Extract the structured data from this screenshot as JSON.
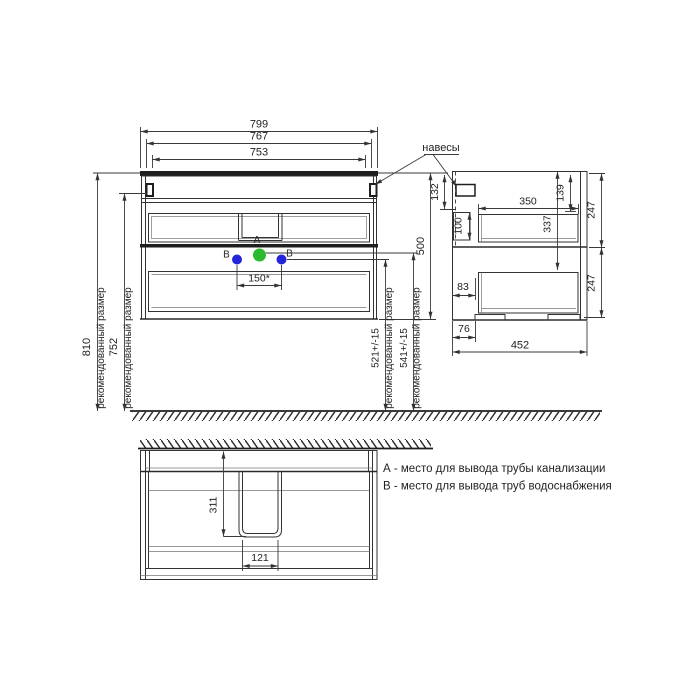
{
  "colors": {
    "line": "#333333",
    "point_a_fill": "#2db92d",
    "point_b_fill": "#2424dd"
  },
  "notes": {
    "recommended": "рекомендованный размер"
  },
  "front_view": {
    "dim_countertop_width": "799",
    "dim_body_width": "767",
    "dim_hanger_span": "753",
    "dim_total_height_recommended": "810",
    "dim_hanger_height_recommended": "752",
    "dim_hanger_drop": "132",
    "dim_cabinet_height": "500",
    "dim_b_level": "521+/-15",
    "dim_a_level": "541+/-15",
    "dim_b_spacing": "150*",
    "hangers_label": "навесы",
    "point_a_label": "А",
    "point_b_label": "В"
  },
  "side_view": {
    "dim_inner_depth": "350",
    "dim_top_inset": "139",
    "dim_top_section_height": "247",
    "dim_rail_height": "100",
    "dim_inner_height": "337",
    "dim_front_inset": "83",
    "dim_bottom_section_height": "247",
    "dim_plinth_inset": "76",
    "dim_depth": "452"
  },
  "plan_view": {
    "dim_cutout_depth": "311",
    "dim_cutout_width": "121"
  },
  "legend": {
    "line_a": "А - место для вывода трубы канализации",
    "line_b": "В - место для вывода труб водоснабжения"
  }
}
